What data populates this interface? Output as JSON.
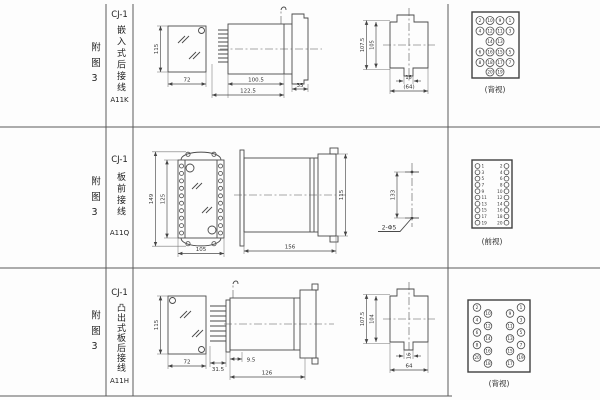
{
  "page": {
    "fig_no": "附图3",
    "rows": [
      {
        "model": "CJ-1",
        "mount": "嵌入式后接线",
        "code": "A11K",
        "view": "(背视)",
        "dims": {
          "height": "115",
          "width": "72",
          "body_len": "100.5",
          "total_len": "122.5",
          "flange": "35",
          "panel_outer": "107.5",
          "panel_inner": "105",
          "slot": "16",
          "panel_width": "(64)"
        },
        "terminals": {
          "r1": [
            "2",
            "10",
            "9",
            "1"
          ],
          "r2": [
            "4",
            "12",
            "11",
            "3"
          ],
          "r3": [
            "14",
            "13"
          ],
          "r4": [
            "6",
            "16",
            "15",
            "5"
          ],
          "r5": [
            "8",
            "18",
            "17",
            "7"
          ],
          "r6": [
            "20",
            "19"
          ]
        }
      },
      {
        "model": "CJ-1",
        "mount": "板前接线",
        "code": "A11Q",
        "view": "(前视)",
        "dims": {
          "outer_h": "149",
          "inner_h": "125",
          "width": "105",
          "total_len": "156",
          "socket_h": "115",
          "hole_span": "133",
          "hole_spec": "2-Φ5"
        },
        "terminals": {
          "left": [
            "1",
            "3",
            "5",
            "7",
            "9",
            "11",
            "13",
            "15",
            "17",
            "19"
          ],
          "right": [
            "2",
            "4",
            "6",
            "8",
            "10",
            "12",
            "14",
            "16",
            "18",
            "20"
          ]
        }
      },
      {
        "model": "CJ-1",
        "mount": "凸出式板后接线",
        "code": "A11H",
        "view": "(背视)",
        "dims": {
          "height": "115",
          "width": "72",
          "pin_len": "31.5",
          "offset": "9.5",
          "body_len": "126",
          "panel_outer": "107.5",
          "panel_inner": "104",
          "slot": "16",
          "panel_width": "64"
        },
        "terminals": {
          "c1": [
            "2",
            "4",
            "6",
            "8",
            "20"
          ],
          "c2": [
            "10",
            "12",
            "14",
            "16",
            "18"
          ],
          "c3": [
            "9",
            "11",
            "13",
            "15",
            "17"
          ],
          "c4": [
            "1",
            "3",
            "5",
            "7",
            "19"
          ]
        }
      }
    ]
  }
}
